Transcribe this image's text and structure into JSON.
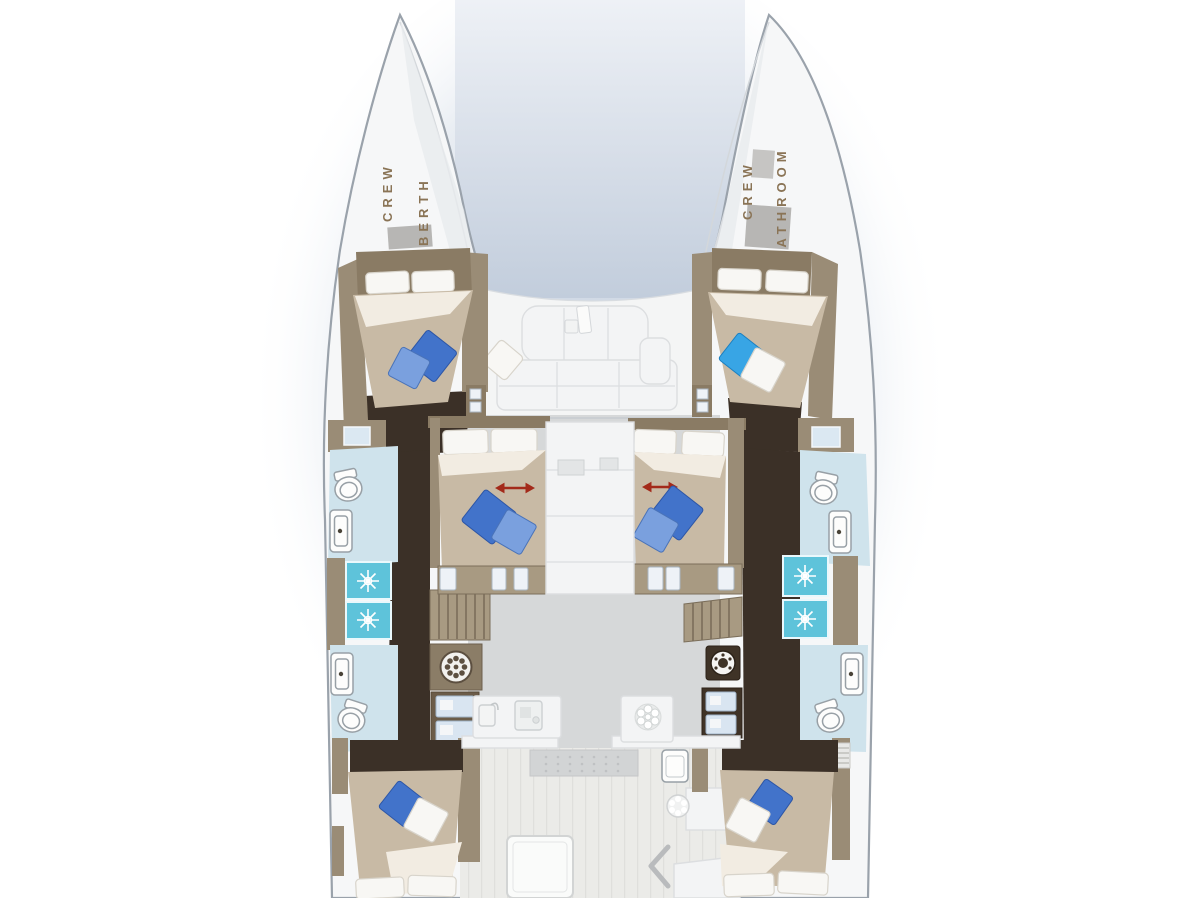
{
  "labels": {
    "crew_berth": [
      "CREW",
      "BERTH"
    ],
    "crew_bathroom": [
      "CREW",
      "BATHROOM"
    ]
  },
  "icons": {
    "shower": "starburst spray",
    "toilet": "oval bowl with tank",
    "sink": "rounded basin with faucet dot",
    "washing_machine": "segmented drum circle",
    "cooktop": "six burner cluster",
    "galley_faucet": "tap over basin",
    "coffee_machine": "square appliance",
    "bed_slide": "red double-headed arrow",
    "stairs": "parallel treads",
    "cockpit_chevron": "left-pointing chevron",
    "cockpit_vent": "petal circle"
  },
  "colors": {
    "hull": "#f6f7f8",
    "hullStroke": "#9aa2ab",
    "wall": "#9a8c76",
    "wallDark": "#8a7b64",
    "corridor": "#3b3027",
    "bed": "#c8baa5",
    "fold": "#f2ece2",
    "pillowWhite": "#f8f7f4",
    "pillowBlue": "#4273ca",
    "pillowBlueLight": "#7aa0de",
    "pillowCyan": "#38a5e5",
    "bath": "#cfe3ec",
    "shower": "#5ec3da",
    "fixtureStroke": "#98a0a6",
    "stairs": "#a89a82",
    "stairLine": "#7b6e5a",
    "fridgeDrawer": "#d9e5f1",
    "arrow": "#a32a1a",
    "label": "#8a7456",
    "saloonFloor": "#d6d8d9",
    "furniture": "#f3f4f5",
    "furnitureStroke": "#dcdee0",
    "deckWood": "#ebebe8",
    "hatch": "#b7b6b4",
    "tableGray": "#d2d4d5",
    "iconGray": "#b9bbbd",
    "cabinetDark": "#6b5c49",
    "applianceDark": "#3f3327",
    "shadow": "#c9d3e1"
  }
}
